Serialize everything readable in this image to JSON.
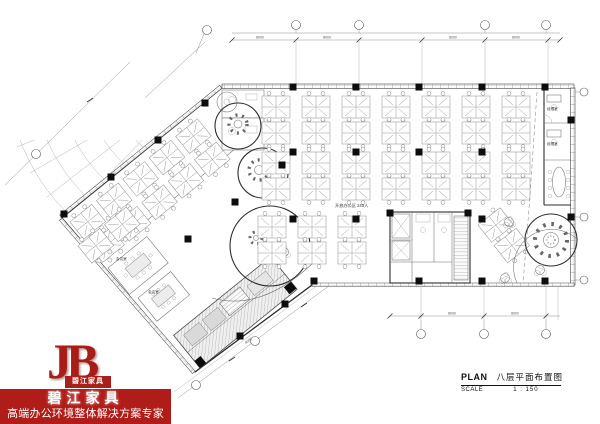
{
  "colors": {
    "brand_red": "#b01c18",
    "logo_red": "#a9201b",
    "drawing_line": "#2e2e2e",
    "background": "#ffffff"
  },
  "logo": {
    "monogram": "JB",
    "monogram_label": "碧江家具",
    "company_name": "碧江家具",
    "tagline": "高端办公环境整体解决方案专家"
  },
  "titleblock": {
    "plan_label": "PLAN",
    "drawing_title": "八层平面布置图",
    "scale_label": "SCALE",
    "scale_value": "1 : 150"
  },
  "plan_labels": {
    "open_office": "开放办公区 240人",
    "manager_office": "经理室",
    "meeting_room": "会议室",
    "dim_top": "8000",
    "dim_bottom": "8000",
    "dim_wing": "8000"
  }
}
